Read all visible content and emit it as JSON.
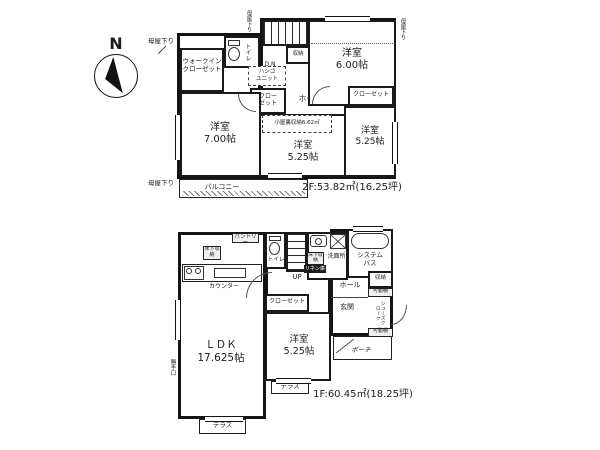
{
  "colors": {
    "ink": "#1a1a1a",
    "paper": "#ffffff"
  },
  "compass": {
    "north": "N"
  },
  "f2": {
    "area": "2F:53.82㎡(16.25坪)",
    "wic": "ウォークイン\nクローゼット",
    "toilet": "トイレ",
    "dn": "D.N",
    "storage": "収納",
    "bedroom6": "洋室\n6.00帖",
    "ladder": "ハシゴ\nユニット",
    "closet_center": "クロー\nゼット",
    "hall": "ホール",
    "attic": "小屋裏収納6.62㎡",
    "bedroom7": "洋室\n7.00帖",
    "bedroom5_center": "洋室\n5.25帖",
    "closet_right": "クローゼット",
    "bedroom5_right": "洋室\n5.25帖",
    "balcony": "バルコニー",
    "moya_top_left": "母屋下り",
    "moya_top_center": "母屋下り",
    "moya_top_right": "母屋下り",
    "moya_left": "母屋下り"
  },
  "f1": {
    "area": "1F:60.45㎡(18.25坪)",
    "ldk": "ＬＤＫ\n17.625帖",
    "counter": "カウンター",
    "pantry": "パントリー",
    "underfloor_kitchen": "床下収納",
    "underfloor_wash": "床下収納",
    "toilet": "トイレ",
    "up": "UP",
    "washroom": "洗面所",
    "linen": "リネン庫",
    "bath": "システム\nバス",
    "storage": "収納",
    "hall": "ホール",
    "closet": "クローゼット",
    "bedroom5": "洋室\n5.25帖",
    "entrance": "玄関",
    "shelf_top": "可動棚",
    "shelf_bottom": "可動棚",
    "shoe_cloak": "シューズクローク",
    "porch": "ポーチ",
    "terrace_right": "テラス",
    "terrace_bottom": "テラス",
    "back_door": "勝手口"
  }
}
